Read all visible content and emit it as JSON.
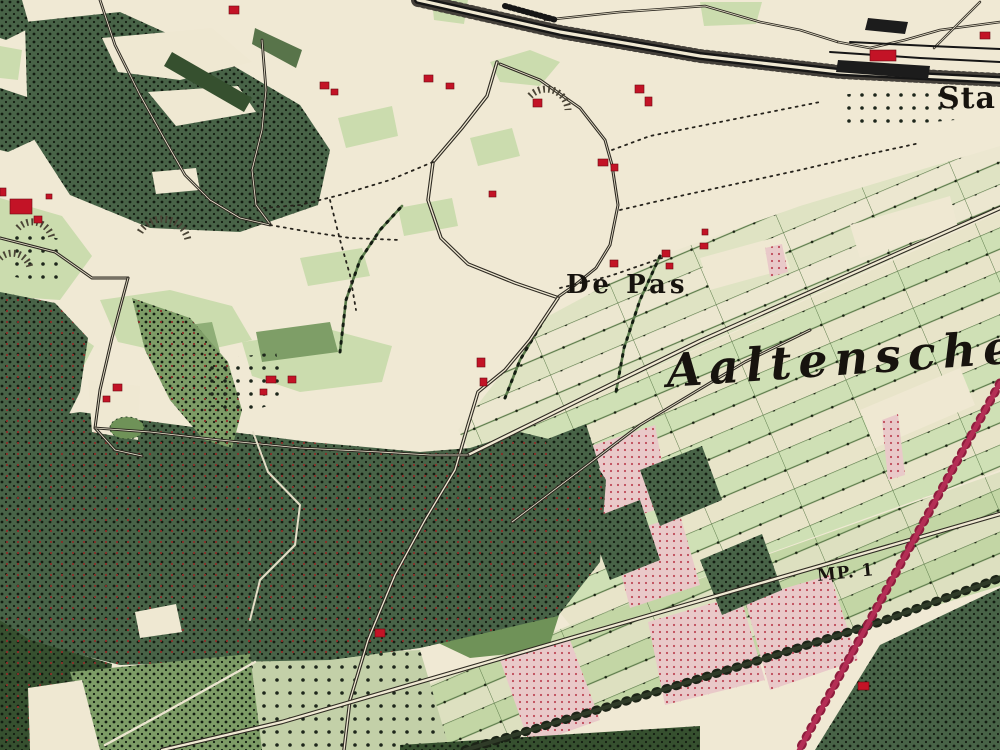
{
  "map_title": "Historical topographic map sheet (De Pas / Aaltensche area)",
  "labels": {
    "de_pas": {
      "text": "De Pas",
      "x": 566,
      "y": 272,
      "size": 26,
      "ls": 4,
      "style": "bold",
      "rot": 0
    },
    "aaltensche": {
      "text": "Aaltensche",
      "x": 668,
      "y": 348,
      "size": 46,
      "ls": 7,
      "style": "bold-italic",
      "rot": -4
    },
    "sta": {
      "text": "Sta",
      "x": 938,
      "y": 84,
      "size": 30,
      "ls": 1,
      "style": "bold",
      "rot": 0
    },
    "mp1": {
      "text": "MP. 1",
      "x": 818,
      "y": 568,
      "size": 17,
      "ls": 1,
      "style": "bold",
      "rot": -6
    }
  },
  "colors": {
    "paper": "#f0e9d4",
    "meadow": "#cbdcae",
    "meadowDark": "#8fae77",
    "cream": "#efe8d2",
    "forest": "#486347",
    "forestDark": "#36502f",
    "plantation": "#7d9c66",
    "field2": "#6f9258",
    "pink": "#e9c9c9",
    "road": "#2e2a22",
    "rail": "#161616",
    "redRail": "#b42e55",
    "building": "#c31326",
    "ink": "#1b1713",
    "treeline": "#5b7b4b",
    "pond": "#6f9258"
  },
  "features": {
    "meadows": [
      {
        "pts": "0,198 62,216 92,256 60,300 0,296"
      },
      {
        "pts": "0,310 52,316 94,346 68,396 0,392"
      },
      {
        "pts": "100,300 170,290 232,306 252,340 180,356 118,342"
      },
      {
        "pts": "242,342 332,330 392,346 382,382 300,392 252,376"
      },
      {
        "pts": "338,118 392,106 398,136 346,148"
      },
      {
        "pts": "470,138 512,128 520,156 478,166"
      },
      {
        "pts": "398,208 452,198 458,226 404,236"
      },
      {
        "pts": "300,258 362,248 370,276 308,286"
      },
      {
        "pts": "0,46 22,50 18,80 0,78"
      },
      {
        "pts": "700,2 762,2 756,24 704,26"
      },
      {
        "pts": "432,0 468,0 464,24 434,20"
      },
      {
        "pts": "490,62 530,50 560,62 540,86 500,82"
      },
      {
        "pts": "255,28 302,50 296,68 252,44",
        "fill": "#58744a"
      },
      {
        "pts": "150,330 212,322 220,352 158,360",
        "fill": "#8fae77"
      },
      {
        "pts": "256,332 330,322 338,352 262,362",
        "fill": "#7e9e67"
      }
    ],
    "stripZones": [
      {
        "pts": "545,318 660,256 800,206 1000,146 1000,210 470,452 458,430",
        "pattern": "stripsLight"
      },
      {
        "pts": "470,452 1000,212 1000,470 570,625 505,545",
        "pattern": "strips"
      },
      {
        "pts": "570,625 1000,472 1000,586 470,748 398,750 380,705",
        "pattern": "strips2"
      }
    ],
    "creamsOverStrips": [
      {
        "pts": "700,258 780,236 790,268 710,290"
      },
      {
        "pts": "850,225 950,196 958,228 860,258"
      },
      {
        "pts": "860,410 960,368 975,405 875,448"
      }
    ],
    "plantations": [
      {
        "pts": "428,598 506,588 560,612 548,650 470,658 432,640",
        "fill": "#6f9258"
      },
      {
        "pts": "230,660 420,650 450,750 240,750",
        "fill": "#c3d0a8",
        "sparse": 1
      }
    ],
    "pinks": [
      {
        "pts": "585,448 655,425 670,505 600,528"
      },
      {
        "pts": "612,538 680,515 700,585 630,608"
      },
      {
        "pts": "648,622 740,595 765,680 665,705"
      },
      {
        "pts": "745,600 830,575 858,660 770,690"
      },
      {
        "pts": "765,248 782,244 788,272 770,277"
      },
      {
        "pts": "882,420 898,414 905,475 888,480"
      },
      {
        "pts": "500,660 570,640 600,720 530,745"
      }
    ],
    "forests": [
      {
        "pts": "25,22 120,12 215,55 300,105 330,150 318,205 240,232 150,228 70,195 28,130",
        "dots": 1
      },
      {
        "pts": "0,88 30,98 34,140 8,152 0,150",
        "dots": 1
      },
      {
        "pts": "0,0 22,0 30,28 6,40 0,38",
        "dots": 1
      },
      {
        "pts": "0,292 55,303 88,338 80,392 62,428 0,424",
        "dots": 1,
        "red": 1
      },
      {
        "pts": "0,424 80,412 200,428 310,442 420,452 470,448 520,432 586,448 606,480 600,562 558,616 498,630 420,648 330,660 230,662 120,665 30,642 0,620",
        "dots": 1,
        "red": 1
      },
      {
        "pts": "0,620 30,640 112,664 100,750 0,750",
        "dots": 1,
        "red": 1,
        "fill": "#36502f"
      },
      {
        "pts": "880,645 1000,588 1000,750 815,750",
        "dots": 1
      },
      {
        "pts": "400,745 700,726 700,750 400,750",
        "fill": "#36502f",
        "dots": 1
      },
      {
        "pts": "640,470 702,446 722,500 660,526",
        "dots": 1
      },
      {
        "pts": "588,520 640,500 660,560 610,580",
        "dots": 1
      },
      {
        "pts": "700,560 762,534 782,590 722,615",
        "dots": 1
      },
      {
        "pts": "545,440 586,424 600,468 560,484",
        "dots": 1
      },
      {
        "pts": "132,298 190,318 228,362 242,410 232,448 204,440 170,400 145,350",
        "fill": "#7d9c66",
        "dots": 1,
        "red": 1
      },
      {
        "pts": "70,672 250,654 262,750 95,750",
        "fill": "#7d9c66",
        "dots": 1
      }
    ],
    "creamsOverForest": [
      {
        "pts": "102,38 212,28 252,62 180,80 118,72"
      },
      {
        "pts": "148,92 238,86 256,112 176,126"
      },
      {
        "pts": "152,172 196,168 200,190 156,194"
      },
      {
        "pts": "28,688 82,680 100,750 30,750"
      },
      {
        "pts": "135,612 176,604 182,632 140,638"
      },
      {
        "pts": "88,380 140,386 138,440 92,432"
      }
    ],
    "allee": {
      "pts": "172,52 252,98 244,112 164,66",
      "fill": "#36502f"
    },
    "orchards": [
      {
        "pts": "200,362 276,352 286,400 240,415 205,405"
      },
      {
        "pts": "5,228 66,240 60,286 10,276"
      },
      {
        "pts": "838,95 950,85 955,120 845,130"
      }
    ],
    "pond": {
      "cx": 127,
      "cy": 428,
      "rx": 17,
      "ry": 11
    },
    "treelines": [
      {
        "pts": "340,352 346,300 360,260 380,230 402,206"
      },
      {
        "pts": "545,318 520,360 505,398"
      },
      {
        "pts": "660,256 640,300 624,348 616,392"
      }
    ],
    "roads": [
      {
        "pts": "497,62 487,96 462,128 433,162 428,200 441,238 468,264 515,283 556,297",
        "w": 3.5
      },
      {
        "pts": "500,64 540,80 580,108 605,140 612,165 618,205 610,245 596,268 575,285 558,297",
        "w": 3
      },
      {
        "pts": "468,455 533,423 620,380 700,341 1000,208",
        "w": 4.5
      },
      {
        "pts": "558,298 530,340 505,370 478,392 468,425 455,470 425,520 395,575 368,640 350,700 344,750",
        "w": 3.5
      },
      {
        "pts": "162,750 282,722 640,618 1000,514",
        "w": 4.5
      },
      {
        "pts": "0,238 55,252 92,278 128,278",
        "w": 3
      },
      {
        "pts": "128,278 112,338 100,390 95,428 115,450 142,456",
        "w": 3
      },
      {
        "pts": "95,428 150,432 220,440 300,448 380,452 430,455 468,455",
        "w": 2.8
      },
      {
        "pts": "262,40 266,90 262,130 252,170 256,205 270,224",
        "w": 2.8
      },
      {
        "pts": "100,0 115,45 140,95 165,140 185,175 210,200 240,218 270,225",
        "w": 2.8
      },
      {
        "pts": "545,20 620,12 705,6 760,22 800,30 838,42",
        "w": 2.5
      },
      {
        "pts": "838,42 870,48 905,40 940,30 1000,22",
        "w": 2.5
      },
      {
        "pts": "980,2 952,30 934,48",
        "w": 2.5
      },
      {
        "pts": "512,522 640,425 745,362 810,330",
        "w": 3
      },
      {
        "pts": "105,745 160,715 255,662",
        "w": 2.4,
        "single": "#ece6d0"
      },
      {
        "pts": "253,432 268,472 300,505 295,545 260,580 250,620",
        "w": 2,
        "single": "#e4ddc6"
      }
    ],
    "darkRoads": [
      {
        "pts": "465,750 610,706 760,660 880,622 1000,578"
      }
    ],
    "dashedPaths": [
      {
        "pts": "560,288 610,276 662,258"
      },
      {
        "pts": "433,162 390,180 340,195 300,205 264,208"
      },
      {
        "pts": "330,200 340,240 350,275 356,310"
      },
      {
        "pts": "612,150 650,136 700,126 760,114 820,102"
      },
      {
        "pts": "620,210 680,196 740,183 800,170 860,156 920,143"
      },
      {
        "pts": "270,225 310,232 350,238 400,240"
      }
    ],
    "railway": {
      "main": "418,0 560,32 700,56 840,72 1000,80",
      "sidings": [
        "830,52 920,58 1000,62",
        "850,42 930,46 1000,49"
      ],
      "ladder": "505,6 556,20",
      "blobs": [
        "838,60 930,66 928,79 836,72",
        "868,18 908,22 905,34 865,30"
      ]
    },
    "redRailway": {
      "pts": "1000,383 905,556 798,752"
    },
    "fans": [
      {
        "d": "M 140,232 A 26,26 0 0 1 188,240"
      },
      {
        "d": "M 18,228 A 20,20 0 0 1 52,238"
      },
      {
        "d": "M 530,96 A 22,22 0 0 1 568,110"
      },
      {
        "d": "M 0,258 A 18,18 0 0 1 30,268"
      }
    ],
    "buildings": [
      {
        "x": 229,
        "y": 6,
        "w": 10,
        "h": 8
      },
      {
        "x": 320,
        "y": 82,
        "w": 9,
        "h": 7
      },
      {
        "x": 331,
        "y": 89,
        "w": 7,
        "h": 6
      },
      {
        "x": 424,
        "y": 75,
        "w": 9,
        "h": 7
      },
      {
        "x": 446,
        "y": 83,
        "w": 8,
        "h": 6
      },
      {
        "x": 533,
        "y": 99,
        "w": 9,
        "h": 8
      },
      {
        "x": 635,
        "y": 85,
        "w": 9,
        "h": 8
      },
      {
        "x": 645,
        "y": 97,
        "w": 7,
        "h": 9
      },
      {
        "x": 598,
        "y": 159,
        "w": 10,
        "h": 7
      },
      {
        "x": 611,
        "y": 164,
        "w": 7,
        "h": 7
      },
      {
        "x": 489,
        "y": 191,
        "w": 7,
        "h": 6
      },
      {
        "x": 10,
        "y": 199,
        "w": 22,
        "h": 15
      },
      {
        "x": 34,
        "y": 216,
        "w": 8,
        "h": 7
      },
      {
        "x": 0,
        "y": 188,
        "w": 6,
        "h": 8
      },
      {
        "x": 46,
        "y": 194,
        "w": 6,
        "h": 5
      },
      {
        "x": 113,
        "y": 384,
        "w": 9,
        "h": 7
      },
      {
        "x": 103,
        "y": 396,
        "w": 7,
        "h": 6
      },
      {
        "x": 266,
        "y": 376,
        "w": 10,
        "h": 7
      },
      {
        "x": 288,
        "y": 376,
        "w": 8,
        "h": 7
      },
      {
        "x": 260,
        "y": 389,
        "w": 7,
        "h": 6
      },
      {
        "x": 477,
        "y": 358,
        "w": 8,
        "h": 9
      },
      {
        "x": 480,
        "y": 378,
        "w": 7,
        "h": 8
      },
      {
        "x": 610,
        "y": 260,
        "w": 8,
        "h": 7
      },
      {
        "x": 662,
        "y": 250,
        "w": 8,
        "h": 7
      },
      {
        "x": 666,
        "y": 263,
        "w": 7,
        "h": 6
      },
      {
        "x": 700,
        "y": 243,
        "w": 8,
        "h": 6
      },
      {
        "x": 702,
        "y": 229,
        "w": 6,
        "h": 6
      },
      {
        "x": 375,
        "y": 629,
        "w": 10,
        "h": 8
      },
      {
        "x": 858,
        "y": 682,
        "w": 11,
        "h": 8
      },
      {
        "x": 870,
        "y": 50,
        "w": 26,
        "h": 11
      },
      {
        "x": 980,
        "y": 32,
        "w": 10,
        "h": 7
      }
    ]
  }
}
